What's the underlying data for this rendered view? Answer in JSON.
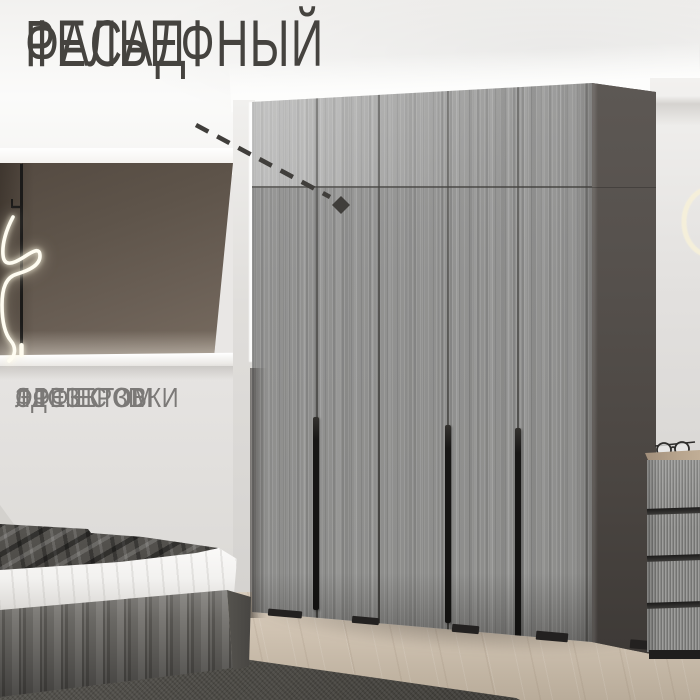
{
  "headline": {
    "line1": "РЕЛЬЕФНЫЙ",
    "line2": "ФАСАД"
  },
  "feature": {
    "line1": "ЛДСП С 3D",
    "line2": "ЭФФЕКТОМ",
    "line3": "ФРЕЗЕРОВКИ"
  },
  "palette": {
    "headline_color": "#45433f",
    "feature_color": "#7b7977",
    "wardrobe_front_gray": "#919190",
    "wardrobe_side_dark": "#4a4541",
    "accent_wall_brown": "#645a50",
    "light_wall": "#e3e1df",
    "floor_wood": "#c8bcab",
    "rug_dark": "#4a4843",
    "handle_black": "#161514",
    "lamp_glow_white": "#fffdf2",
    "ring_glow_cream": "#f6f0da",
    "arrow_color": "#403e3b"
  }
}
